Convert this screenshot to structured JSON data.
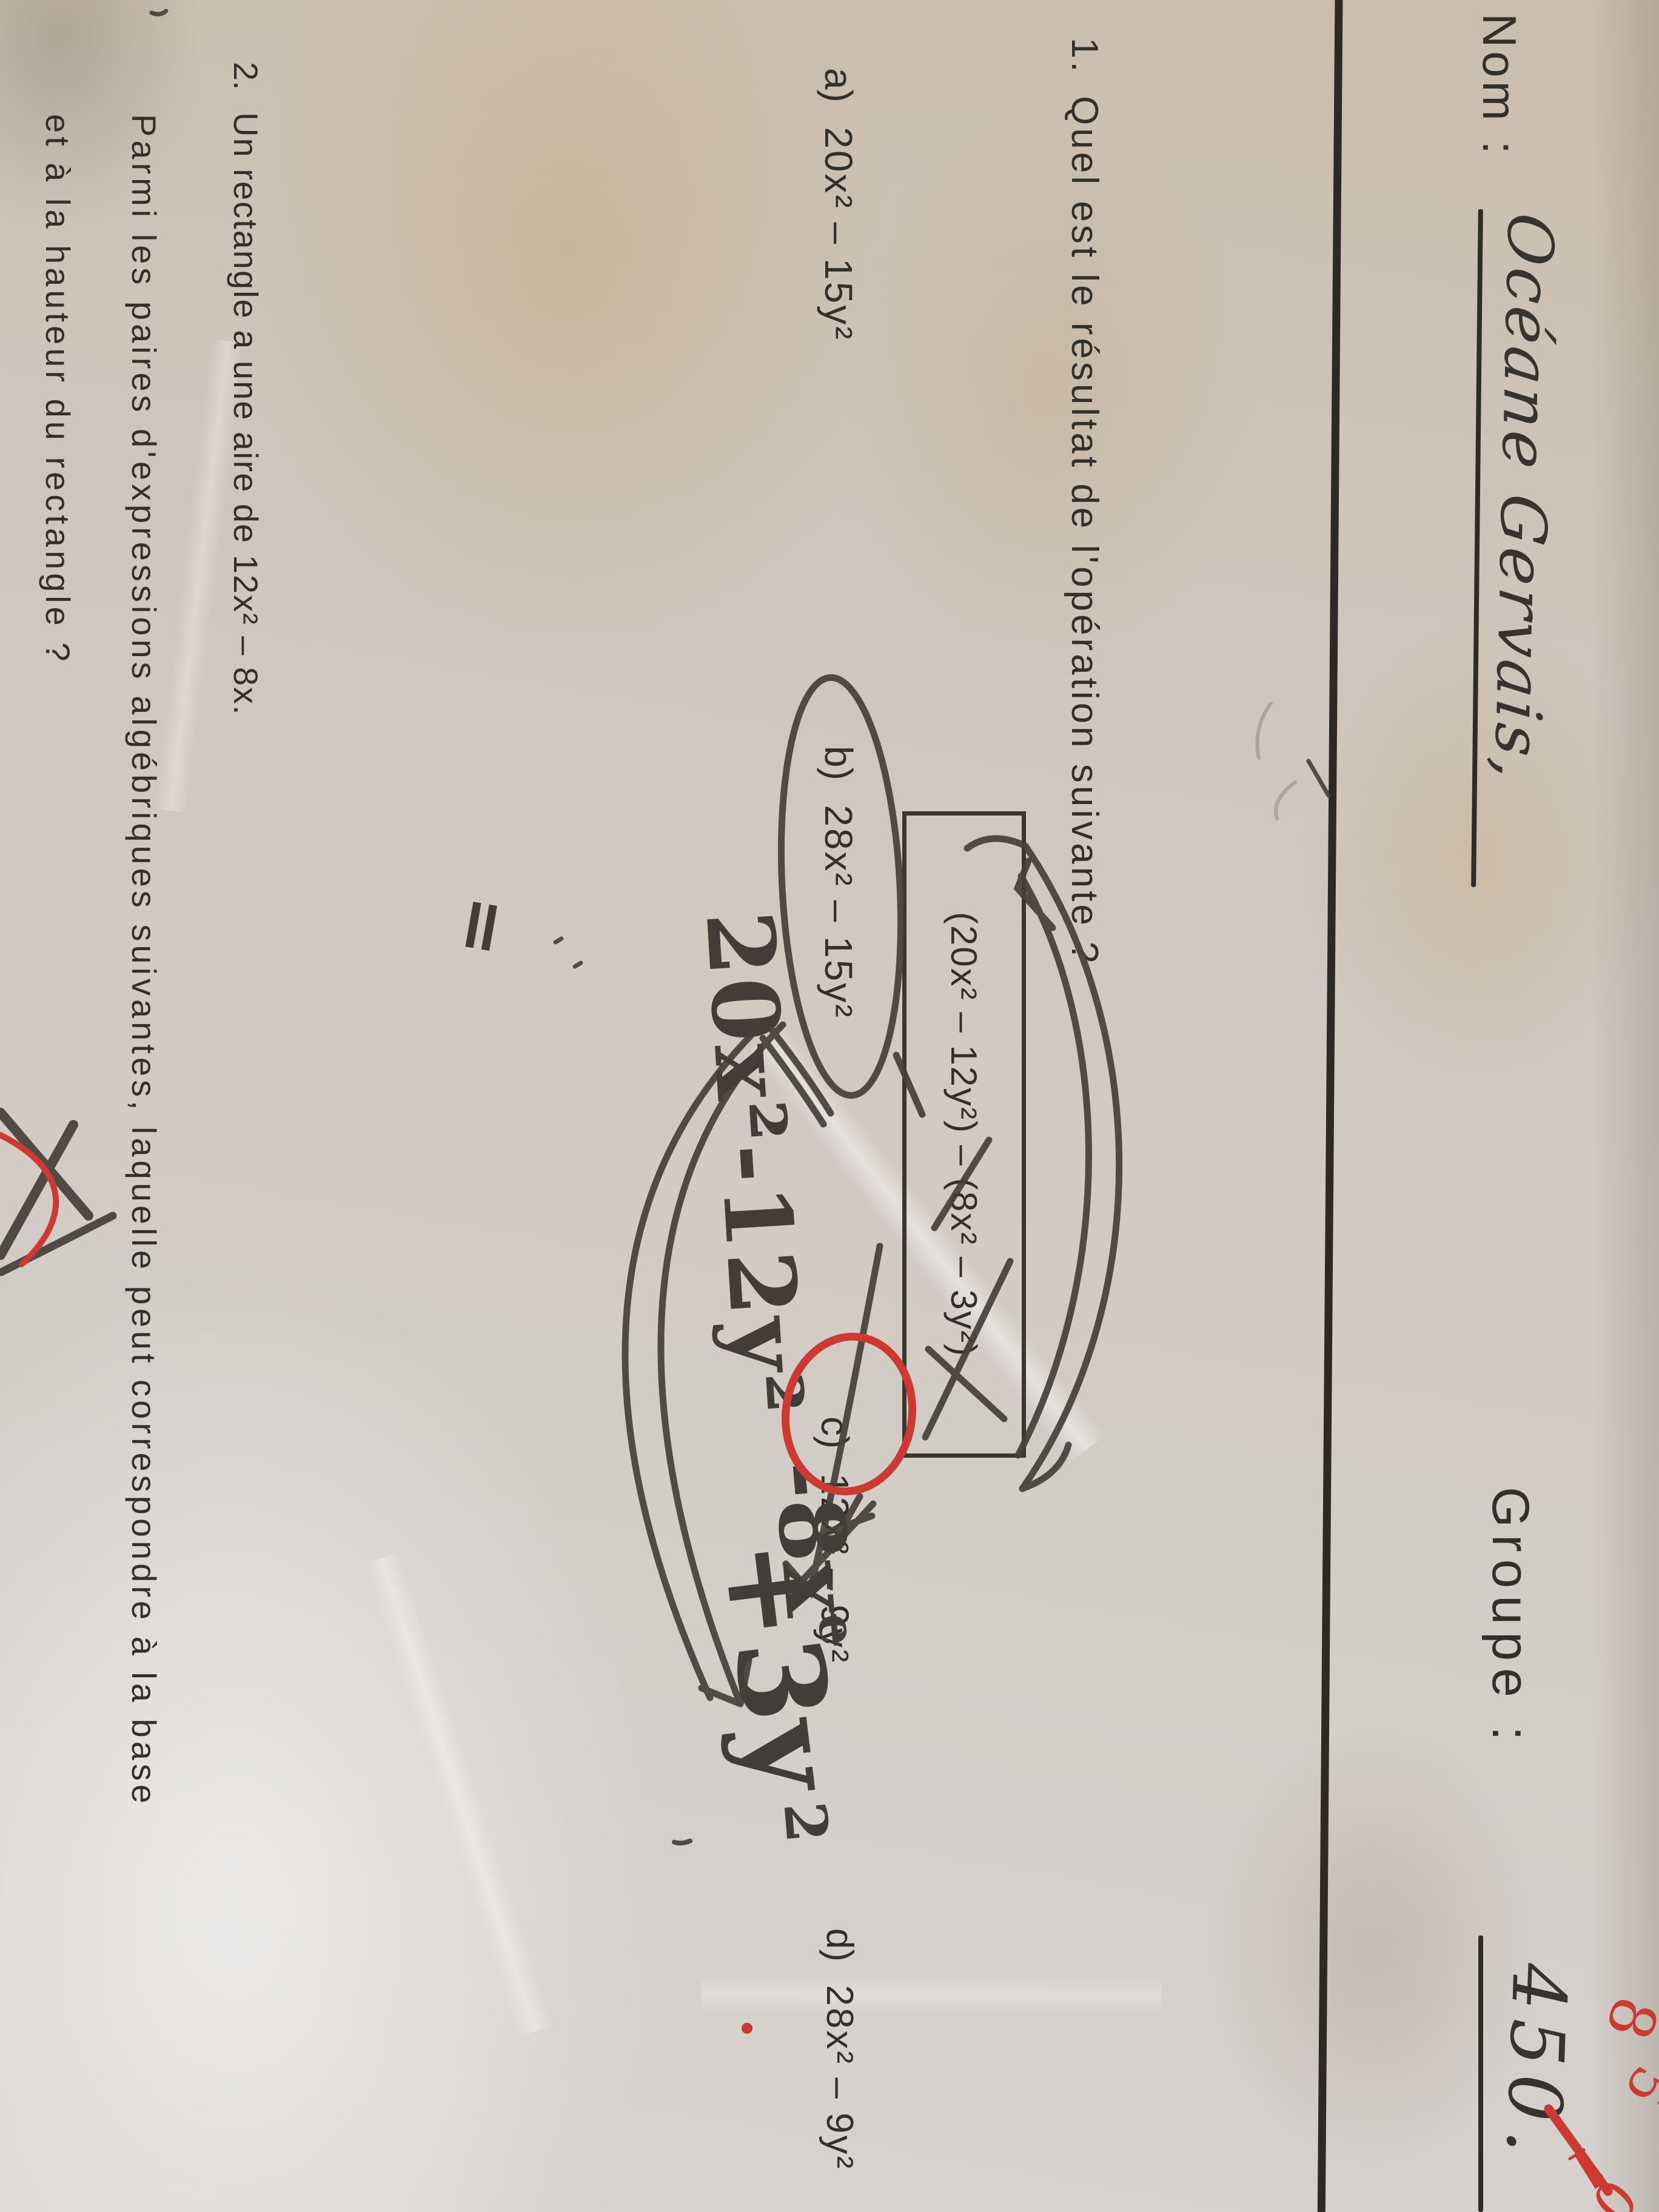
{
  "header": {
    "nom_label": "Nom :",
    "nom_value": "Océane Gervais,",
    "groupe_label": "Groupe :",
    "groupe_value": "450."
  },
  "grade": {
    "parts": [
      "8",
      "5",
      "1",
      "0"
    ],
    "slash": "/",
    "color": "#cd3a32"
  },
  "q1": {
    "number": "1.",
    "text": "Quel est le résultat de l'opération suivante ?",
    "boxed_expression": "(20x² – 12y²) – (8x² – 3y²)",
    "options": [
      {
        "label": "a)",
        "value": "20x² – 15y²"
      },
      {
        "label": "b)",
        "value": "28x² – 15y²"
      },
      {
        "label": "c)",
        "value": "12x² – 9y²"
      },
      {
        "label": "d)",
        "value": "28x² – 9y²"
      }
    ]
  },
  "marks": {
    "penciled_option": "b)",
    "red_circled_option": "c)"
  },
  "handwriting": {
    "equals": "=",
    "expr_a": "20x²-12y²",
    "expr_b": "-8x",
    "expr_b_sup": "e",
    "expr_c": "+3y",
    "expr_c_sup": "2"
  },
  "q2": {
    "number": "2.",
    "line1": "Un rectangle a une aire de 12x² – 8x.",
    "line2": "Parmi les paires d'expressions algébriques suivantes, laquelle peut correspondre à la base",
    "line3": "et à la hauteur du rectangle ?"
  }
}
